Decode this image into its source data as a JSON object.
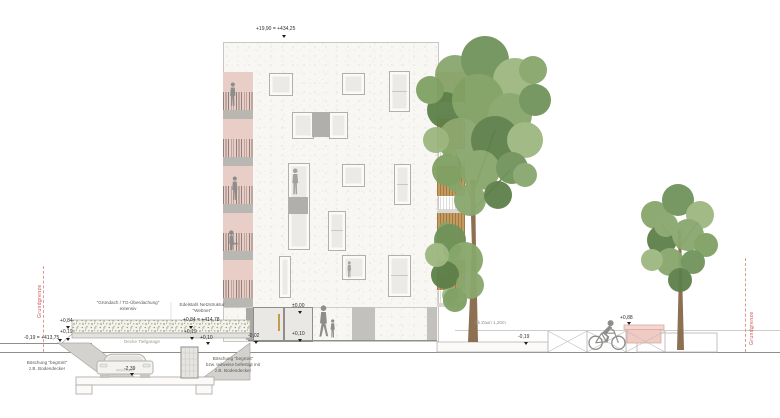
{
  "drawing": {
    "levels": {
      "roof": "+19,90 = +434,25",
      "garage_roof_left": "+0,84",
      "garage_slab_left": "+0,19",
      "ground_left": "-0,19 = +413,75",
      "garage_roof_right": "+0,84 = +414,78",
      "garage_slab_right": "+0,19",
      "garage_walk_right": "+0,10",
      "garage_floor": "-2,39",
      "storefront": "±0,00",
      "entrance": "-0,02",
      "entrance_walk": "+0,10",
      "street": "-0,19",
      "bench": "+0,88"
    },
    "labels": {
      "green_roof_line1": "\"Gründach / TG-Überdachung\"",
      "green_roof_line2": "extensiv",
      "mesh_line1": "Edelstahl Netzstruktur",
      "mesh_line2": "\"Webnet\"",
      "garage_ceiling": "Decke Tiefgarage",
      "slope_left_line1": "Böschung \"begrünt\"",
      "slope_left_line2": "z.B. Bodendecker",
      "slope_right_line1": "Böschung \"begrünt\"",
      "slope_right_line2": "bzw. teilweise befestigt mit",
      "slope_right_line3": "z.B. Bodendecker",
      "fence": "Ok Zaun 1,20m",
      "property_line_left": "Grundgrenze",
      "property_line_right": "Grundgrenze"
    },
    "colors": {
      "annotation_red": "#c4504a",
      "facade": "#f8f7f4",
      "loggia_pink": "#e8cec7",
      "wood": "#c49a5f",
      "foliage_green": "#7b9a60",
      "figure_gray": "#8d8d8b"
    }
  }
}
